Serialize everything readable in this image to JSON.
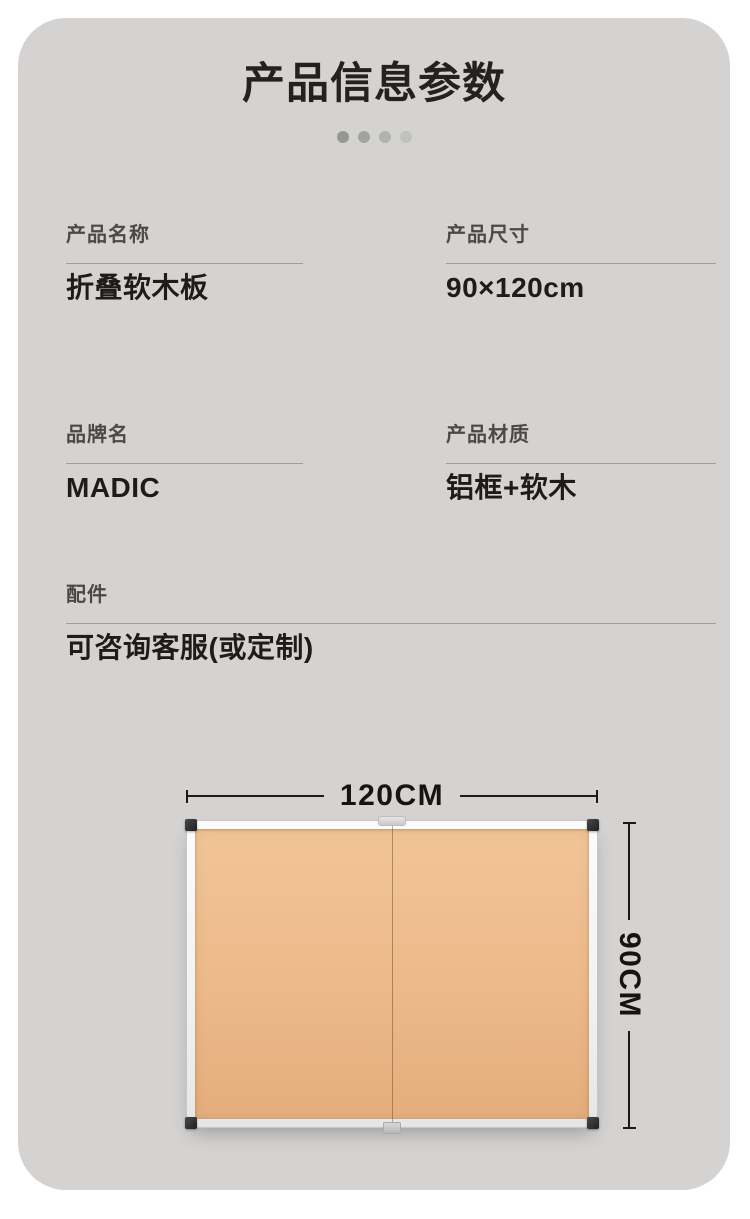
{
  "page": {
    "title": "产品信息参数",
    "pagination_dot_count": 4
  },
  "specs": [
    {
      "label": "产品名称",
      "value": "折叠软木板"
    },
    {
      "label": "产品尺寸",
      "value": "90×120cm"
    },
    {
      "label": "品牌名",
      "value": "MADIC"
    },
    {
      "label": "产品材质",
      "value": "铝框+软木"
    },
    {
      "label": "配件",
      "value": "可咨询客服(或定制)"
    }
  ],
  "diagram": {
    "width_label": "120CM",
    "height_label": "90CM"
  },
  "colors": {
    "card_background": "#d4d3d1",
    "title_text": "#242220",
    "label_text": "#4c4845",
    "value_text": "#1e1c1a",
    "divider": "#9e9e9c",
    "dimension_line": "#1a1a1a",
    "cork_surface": "#ecb98a",
    "board_frame": "#f1f1f1",
    "corner_cap": "#2a2a2c"
  }
}
